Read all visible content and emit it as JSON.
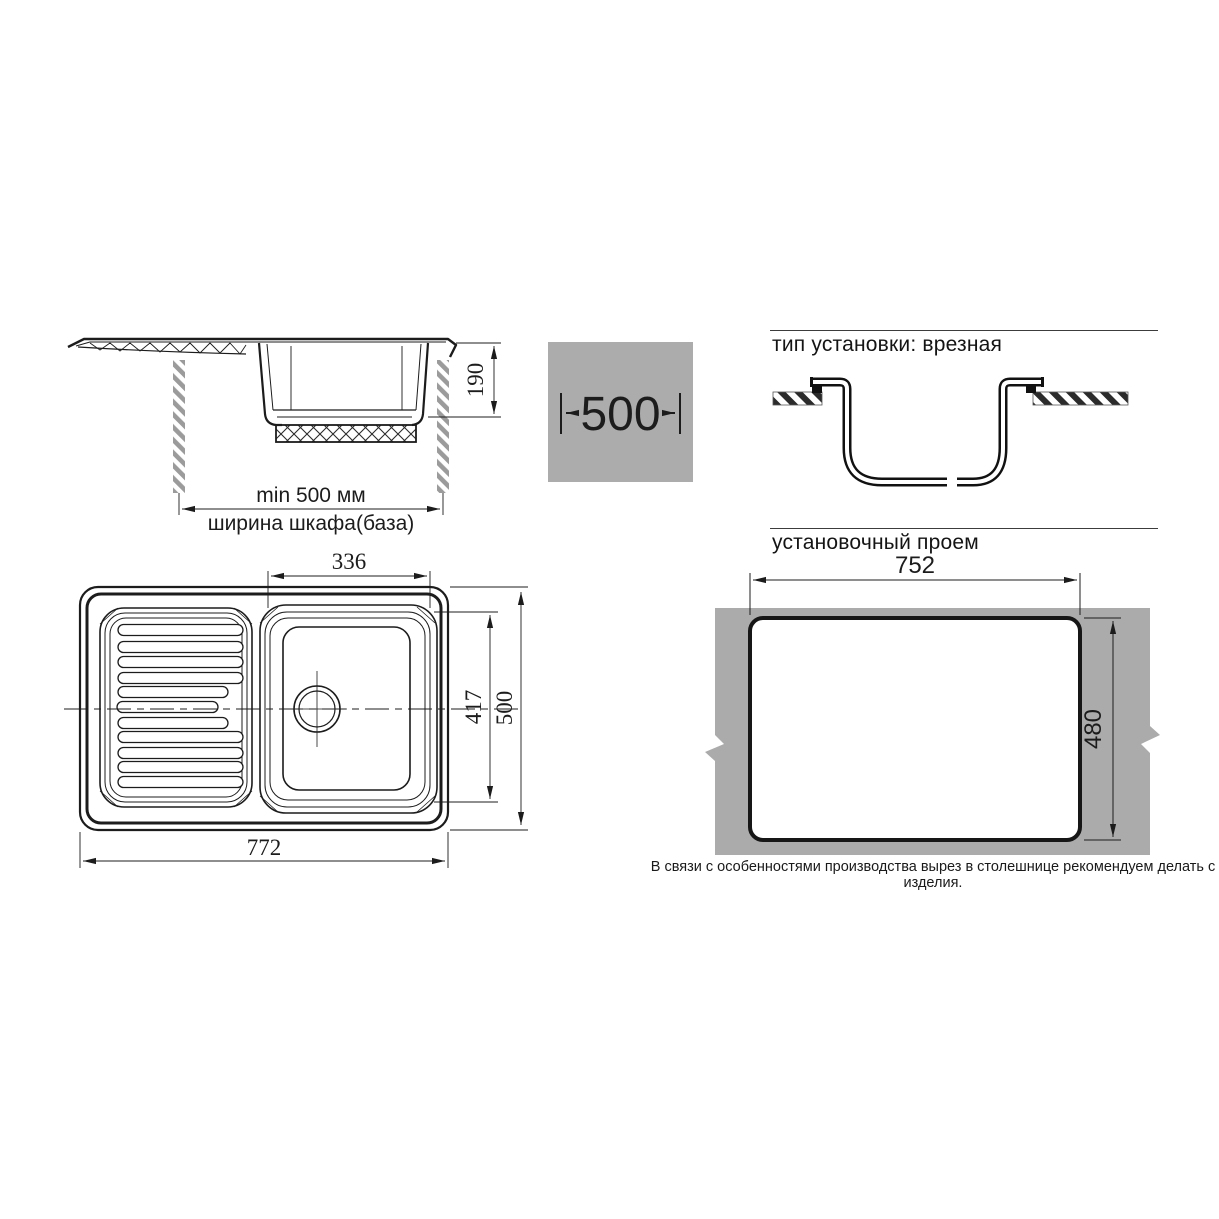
{
  "side_view": {
    "depth_dim": "190",
    "cabinet_min_width": "min 500 мм",
    "cabinet_width_label": "ширина шкафа(база)"
  },
  "cabinet_width_badge": {
    "value": "500"
  },
  "installation": {
    "type_heading": "тип установки: врезная",
    "opening_heading": "установочный проем",
    "opening_width": "752",
    "opening_height": "480",
    "note": "В связи с особенностями производства вырез в столешнице рекомендуем делать с изделия."
  },
  "top_view": {
    "bowl_width": "336",
    "bowl_depth": "417",
    "overall_depth": "500",
    "overall_width": "772"
  },
  "colors": {
    "badge_gray": "#acacac",
    "countertop_gray": "#ababab",
    "line_dark": "#1c1c1c",
    "hatch_gray": "#9b9b9b"
  }
}
